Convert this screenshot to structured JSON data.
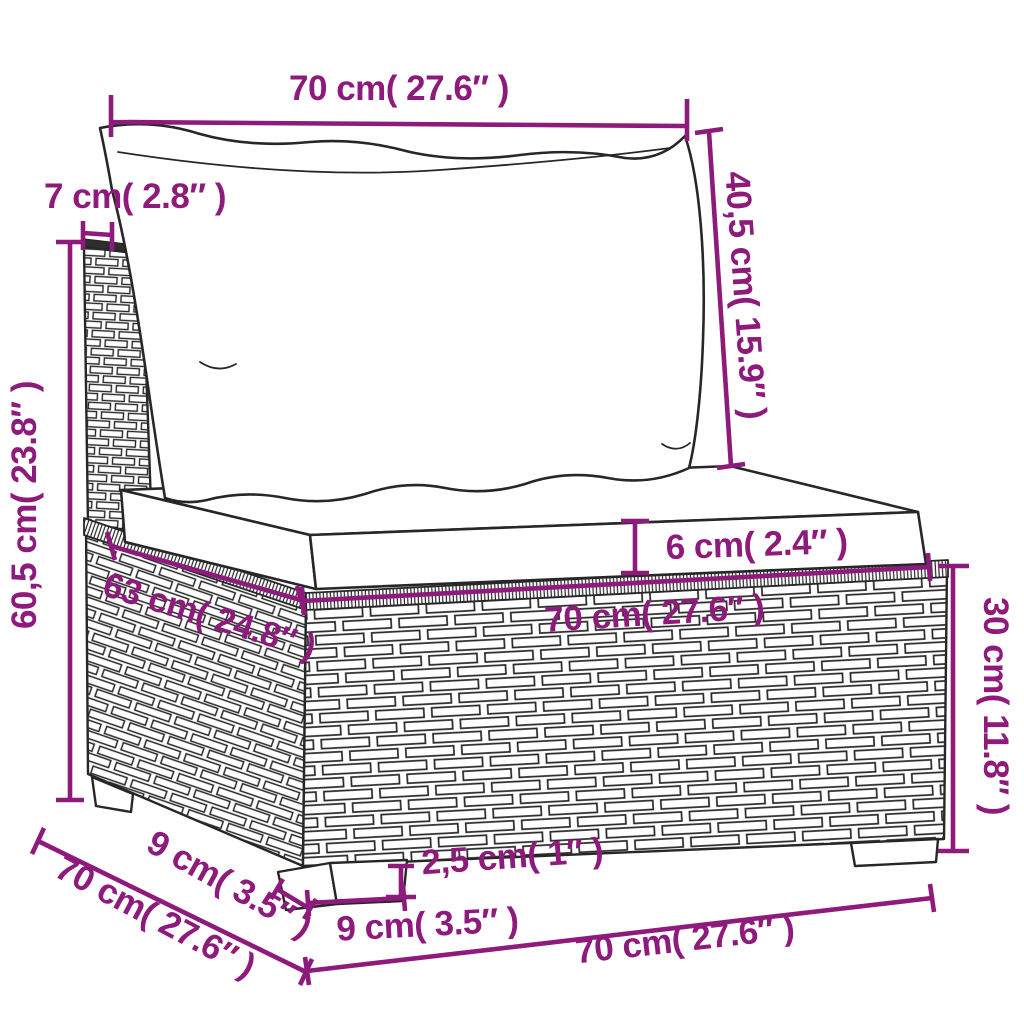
{
  "diagram": {
    "accent_color": "#8e1a7c",
    "ink_color": "#272727",
    "dimensions": {
      "cushion_width": {
        "label": "70 cm( 27.6″ )"
      },
      "back_cushion_height": {
        "label": "40,5 cm( 15.9″ )"
      },
      "back_thickness": {
        "label": "7 cm( 2.8″ )"
      },
      "total_height": {
        "label": "60,5 cm( 23.8″ )"
      },
      "seat_thickness": {
        "label": "6 cm( 2.4″ )"
      },
      "seat_width": {
        "label": "70 cm( 27.6″ )"
      },
      "seat_depth": {
        "label": "63 cm( 24.8″ )"
      },
      "base_height": {
        "label": "30 cm( 11.8″ )"
      },
      "base_depth": {
        "label": "70 cm( 27.6″ )"
      },
      "leg_depth": {
        "label": "9 cm( 3.5″ )"
      },
      "leg_height": {
        "label": "2,5 cm( 1″ )"
      },
      "leg_width": {
        "label": "9 cm( 3.5″ )"
      },
      "base_width": {
        "label": "70 cm( 27.6″ )"
      }
    }
  }
}
